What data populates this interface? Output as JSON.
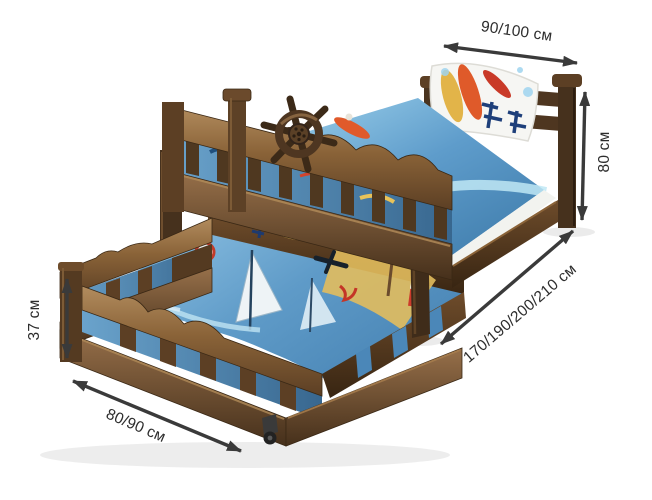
{
  "image": {
    "width": 652,
    "height": 500,
    "background": "#ffffff",
    "alt": "Wooden kids bed with pull-out trundle, surf-print bedding, annotated with dimensions"
  },
  "colors": {
    "arrow": "#3a3a3a",
    "label": "#2d2d2d",
    "wood_dark": "#4a331e",
    "wood_mid": "#6e4c2b",
    "wood_light": "#a8825a",
    "bedding_blue": "#4e8fc0",
    "pillow_white": "#f6f6f3"
  },
  "dimensions": {
    "head_width": {
      "label": "90/100 см"
    },
    "bed_height": {
      "label": "80 см"
    },
    "bed_length": {
      "label": "170/190/200/210 см"
    },
    "trundle_height": {
      "label": "37 см"
    },
    "trundle_width": {
      "label": "80/90 см"
    }
  },
  "icons": {
    "ship_wheel": "ship-wheel",
    "caster_wheel": "caster-wheel"
  }
}
